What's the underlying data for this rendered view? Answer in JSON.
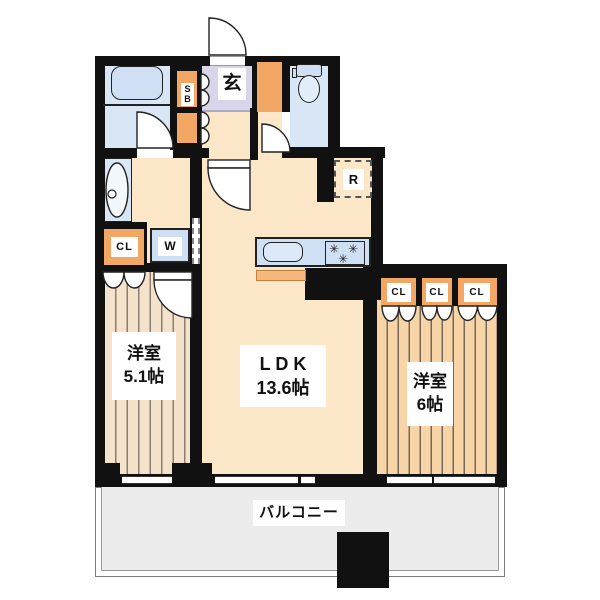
{
  "rooms": {
    "bedroom_left": {
      "label": "洋室",
      "area": "5.1帖"
    },
    "ldk": {
      "label": "L D K",
      "area": "13.6帖"
    },
    "bedroom_right": {
      "label": "洋室",
      "area": "6帖"
    },
    "balcony": {
      "label": "バルコニー"
    },
    "entrance": {
      "label": "玄"
    }
  },
  "fixtures": {
    "shoe_box_line1": "S",
    "shoe_box_line2": "B",
    "refrigerator": "R",
    "washing_machine": "W",
    "closet_left": "CL",
    "closets_right": [
      "CL",
      "CL",
      "CL"
    ],
    "stove_burner_glyph": "✳"
  },
  "colors": {
    "wall": "#111111",
    "floor_cream": "#fce8c9",
    "wet_area_blue": "#d9e6f5",
    "fixture_blue": "#cfe0f4",
    "genkan_lavender": "#d8d4e9",
    "cabinet_orange": "#f2a765",
    "balcony_gray": "#ececec",
    "bedroom_left_stripe": "#f5e2cb",
    "bedroom_right_stripe": "#f8d5a6"
  }
}
